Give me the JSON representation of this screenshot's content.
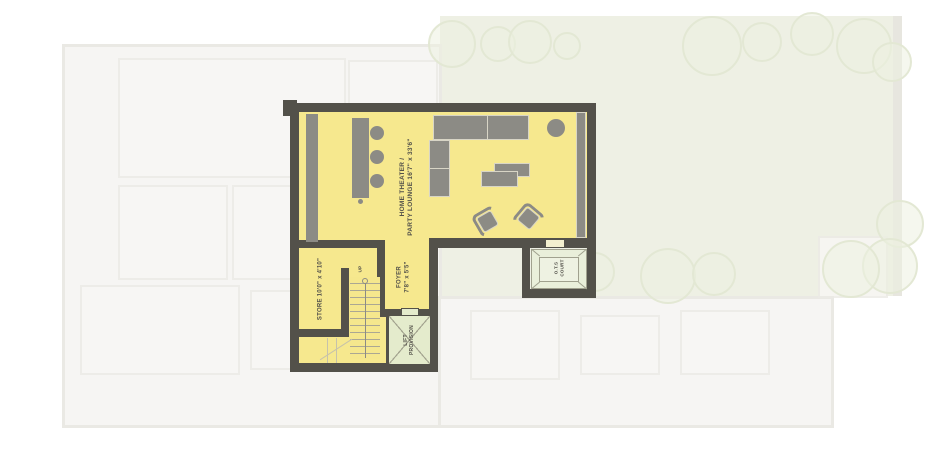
{
  "unit_plan": {
    "home_theater": {
      "line1": "HOME THEATER /",
      "line2": "PARTY LOUNGE 16'7\" x 33'6\""
    },
    "store": {
      "label": "STORE 10'0\" x 4'10\""
    },
    "foyer": {
      "line1": "FOYER",
      "line2": "7'8\" x 5'5\""
    },
    "lift": {
      "line1": "LIFT",
      "line2": "PROVISION"
    },
    "ots_court": {
      "line1": "O.T.S",
      "line2": "COURT"
    },
    "stairs": {
      "up_label": "UP"
    }
  },
  "colors": {
    "highlight_fill": "#F6E88E",
    "wall": "#53514A",
    "furniture": "#8C8B85",
    "lift_fill": "#E4EBCC",
    "court_fill": "#E9EFDA",
    "lawn": "#EEF0E4",
    "faded_plan": "#F4F3F1",
    "label_text": "#53514A"
  }
}
